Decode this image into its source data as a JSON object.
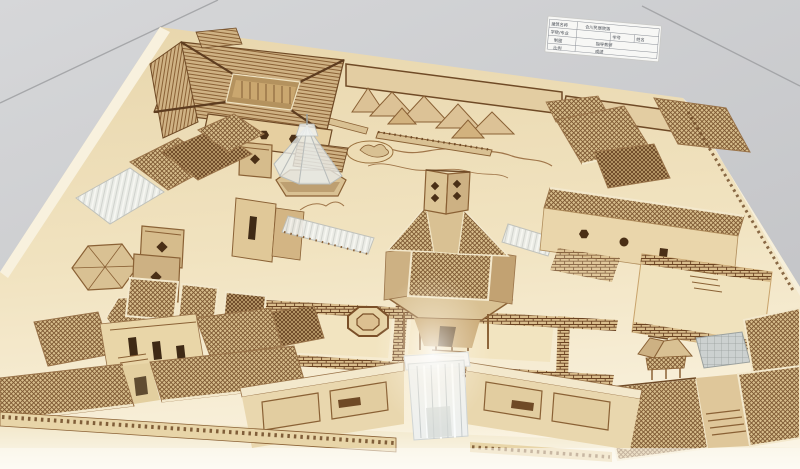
{
  "photo": {
    "subject": "Overhead photograph of a laser-cut plywood architectural model of a traditional Chinese courtyard building complex, with lattice roofs, a central hexagonal pavilion tower, acrylic-roofed corridors, a pond with bridge, brick-paved courtyards and a frosted-acrylic entrance gate, displayed on a gray tiled floor with a white information card at the top right"
  },
  "info_card": {
    "rows": [
      {
        "cells": [
          "建筑名称",
          "合川民居院落"
        ]
      },
      {
        "cells": [
          "学院/专业",
          "学号",
          "姓名"
        ]
      },
      {
        "cells": [
          "制图",
          "指导教师"
        ]
      },
      {
        "cells": [
          "比例",
          "成绩"
        ]
      }
    ]
  },
  "palette": {
    "floor_gray": "#cbccce",
    "grout_gray": "#9b9c9f",
    "board_wood": "#ecdbb3",
    "board_highlight": "#f7efda",
    "wood_tan": "#d9c193",
    "wood_mid": "#c2a272",
    "frame_brown": "#8a6135",
    "dark_brown": "#6f4a26",
    "cutout_dark": "#4a2f16",
    "lattice_dark": "#7a5630",
    "acrylic_white": "#e9edec",
    "card_white": "#f7f7f5"
  }
}
